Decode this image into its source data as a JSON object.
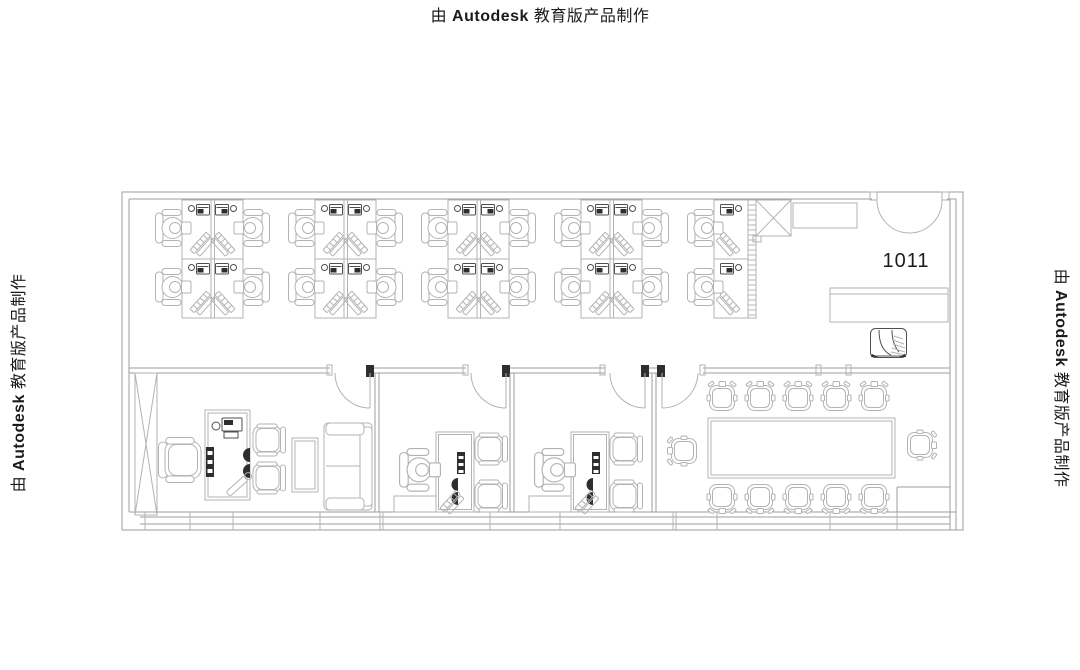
{
  "watermark": {
    "prefix": "由",
    "brand": "Autodesk",
    "suffix": "教育版产品制作",
    "full_text": "由 Autodesk 教育版产品制作"
  },
  "plan": {
    "room_label": "1011"
  },
  "colors": {
    "background": "#ffffff",
    "wall_line": "#9d9d9d",
    "furniture_line": "#b3b3b3",
    "dark_accent": "#2e2e2e",
    "text": "#1b1b1b"
  },
  "icons": [
    "workstation-cluster",
    "office-chair-with-person-icon",
    "desk-phone-icon",
    "keyboard-icon",
    "door-swing-icon",
    "double-door-icon",
    "shaft-x-box-icon",
    "wardrobe-x-cabinet-icon",
    "executive-chair-icon",
    "guest-chair-icon",
    "sofa-icon",
    "coffee-table-icon",
    "conference-table-icon",
    "conference-chair-icon",
    "sketch-armchair-icon",
    "sideboard-counter-icon",
    "hatched-wall-icon",
    "window-band-icon"
  ]
}
